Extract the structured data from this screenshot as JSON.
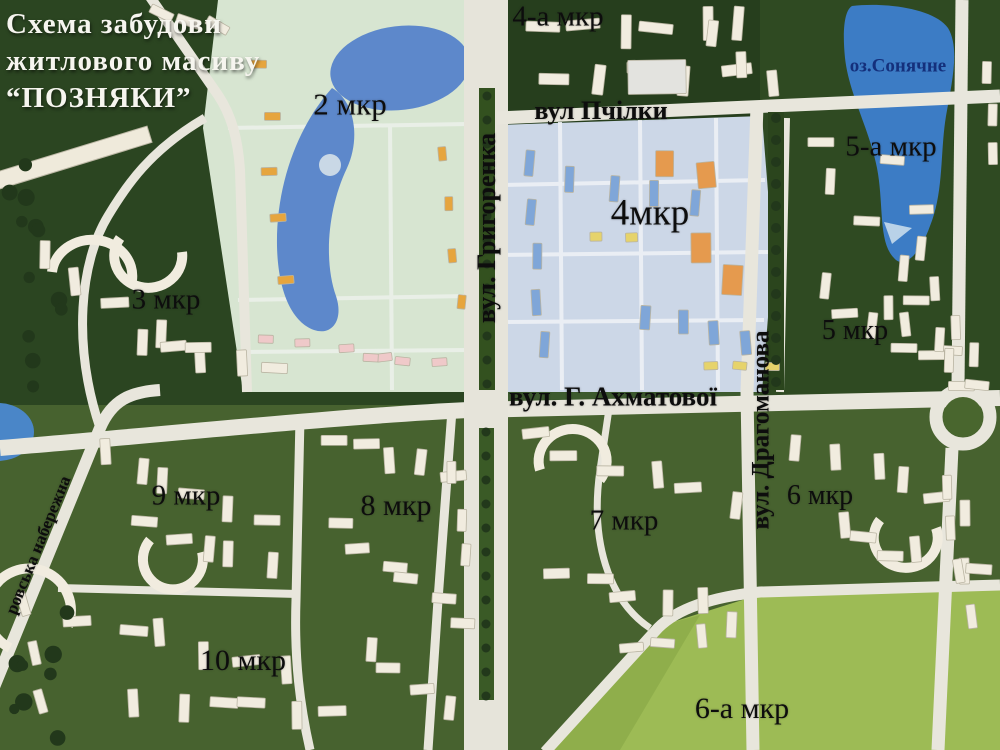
{
  "title": {
    "line1": "Схема забудови",
    "line2": "житлового масиву",
    "line3": "“ПОЗНЯКИ”"
  },
  "districts": [
    {
      "id": "2",
      "label": "2 мкр"
    },
    {
      "id": "3",
      "label": "3 мкр"
    },
    {
      "id": "4a",
      "label": "4-а мкр"
    },
    {
      "id": "4",
      "label": "4мкр"
    },
    {
      "id": "5a",
      "label": "5-а мкр"
    },
    {
      "id": "5",
      "label": "5 мкр"
    },
    {
      "id": "6",
      "label": "6 мкр"
    },
    {
      "id": "6a",
      "label": "6-а мкр"
    },
    {
      "id": "7",
      "label": "7 мкр"
    },
    {
      "id": "8",
      "label": "8 мкр"
    },
    {
      "id": "9",
      "label": "9 мкр"
    },
    {
      "id": "10",
      "label": "10 мкр"
    }
  ],
  "streets": [
    {
      "id": "hryhorenka",
      "label": "вул. Григоренка"
    },
    {
      "id": "akhmatovoi",
      "label": "вул. Г. Ахматової"
    },
    {
      "id": "drahomanova",
      "label": "вул. Драгоманова"
    },
    {
      "id": "pchilky",
      "label": "вул Пчілки"
    },
    {
      "id": "naberezhna",
      "label": "ровська набережна"
    }
  ],
  "water": [
    {
      "id": "soniachne",
      "label": "оз.Сонячне"
    }
  ],
  "colors": {
    "terrain_green": "#3c5a2e",
    "dark_green": "#2b4521",
    "field_green": "#9dbb55",
    "road": "#e8e6dc",
    "water_blue": "#3c7cc5",
    "plan2_bg": "#d7e5d1",
    "plan4_bg": "#ccd7e7",
    "model_building": "#f1ecdf"
  }
}
